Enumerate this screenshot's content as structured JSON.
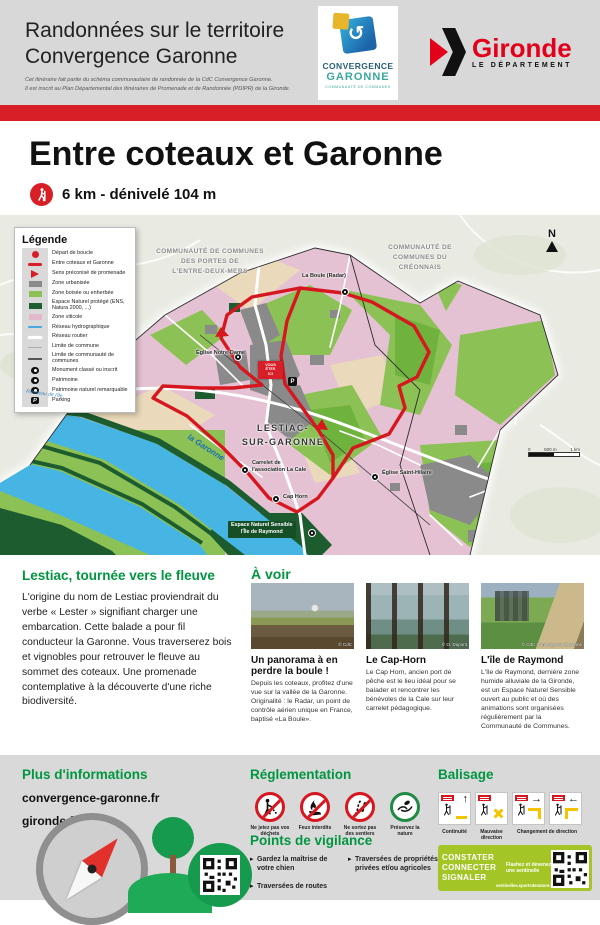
{
  "colors": {
    "accent_red": "#d81e26",
    "heading_green": "#009640",
    "banner_green": "#a3c626",
    "map_vineyard": "#e5c2d3",
    "map_wood": "#8cc155",
    "map_protected": "#1d5d2f",
    "map_water": "#46b5e3"
  },
  "header": {
    "title_line1": "Randonnées sur le territoire",
    "title_line2": "Convergence Garonne",
    "note_line1": "Cet itinéraire fait partie du schéma communautaire de randonnée de la CdC Convergence Garonne.",
    "note_line2": "Il est inscrit au Plan Départemental des Itinéraires de Promenade et de Randonnée (PDIPR) de la Gironde.",
    "convergence_logo": {
      "title1": "CONVERGENCE",
      "title2": "GARONNE",
      "subtitle": "COMMUNAUTÉ DE COMMUNES",
      "swirl": "↺"
    },
    "gironde_logo": {
      "name": "Gironde",
      "department": "LE DÉPARTEMENT"
    }
  },
  "trail": {
    "title": "Entre coteaux et Garonne",
    "stats": "6 km - dénivelé 104 m"
  },
  "map": {
    "legend": {
      "title": "Légende",
      "items": [
        {
          "icon": "route-start",
          "label": "Départ de boucle"
        },
        {
          "icon": "route-line",
          "label": "Entre coteaux et Garonne"
        },
        {
          "icon": "direction-arrow",
          "label": "Sens préconisé de promenade"
        },
        {
          "icon": "zone-urban",
          "label": "Zone urbanisée"
        },
        {
          "icon": "zone-wooded",
          "label": "Zone boisée ou enherbée"
        },
        {
          "icon": "zone-protected",
          "label": "Espace Naturel protégé (ENS, Natura 2000, ...)"
        },
        {
          "icon": "zone-vineyard",
          "label": "Zone viticole"
        },
        {
          "icon": "hydro-network",
          "label": "Réseau hydrographique"
        },
        {
          "icon": "road-network",
          "label": "Réseau routier"
        },
        {
          "icon": "commune-limit",
          "label": "Limite de commune"
        },
        {
          "icon": "cdc-limit",
          "label": "Limite de communauté de communes"
        },
        {
          "icon": "monument",
          "label": "Monument classé ou inscrit"
        },
        {
          "icon": "heritage",
          "label": "Patrimoine"
        },
        {
          "icon": "natural-heritage",
          "label": "Patrimoine naturel remarquable"
        },
        {
          "icon": "parking",
          "label": "Parking"
        }
      ]
    },
    "labels": {
      "cc_left_l1": "COMMUNAUTÉ DE COMMUNES",
      "cc_left_l2": "DES PORTES DE",
      "cc_left_l3": "L'ENTRE-DEUX-MERS",
      "cc_right_l1": "COMMUNAUTÉ DE",
      "cc_right_l2": "COMMUNES DU",
      "cc_right_l3": "CRÉONNAIS",
      "town_l1": "LESTIAC-",
      "town_l2": "SUR-GARONNE",
      "la_boule": "La Boule (Radar)",
      "eglise_notre_dame": "Église Notre-Dame",
      "carrelet_l1": "Carrelet de",
      "carrelet_l2": "l'association La Cale",
      "cap_horn": "Cap Horn",
      "ens_l1": "Espace Naturel Sensible",
      "ens_l2": "l'Île de Raymond",
      "eglise_saint_hilaire": "Église Saint-Hilaire",
      "garonne": "la Garonne",
      "ruisseau": "Ruisseau de l'Île",
      "you_are_here_l1": "VOUS",
      "you_are_here_l2": "ÊTES",
      "you_are_here_l3": "ICI",
      "parking_glyph": "P",
      "north": "N"
    },
    "scale": {
      "start": "0",
      "mid": "500 m",
      "end": "1 km"
    }
  },
  "description": {
    "heading": "Lestiac, tournée vers le fleuve",
    "body": "L'origine du nom de Lestiac proviendrait du verbe « Lester » signifiant charger une embarcation. Cette balade a pour fil conducteur la Garonne. Vous traverserez bois et vignobles pour retrouver le fleuve au sommet des coteaux. Une promenade contemplative à la découverte d'une riche biodiversité."
  },
  "a_voir": {
    "heading": "À voir",
    "cards": [
      {
        "title": "Un panorama à en perdre la boule !",
        "text": "Depuis les coteaux, profitez d'une vue sur la vallée de la Garonne. Originalité : le Radar, un point de contrôle aérien unique en France, baptisé «La Boule».",
        "credit": "© CdC"
      },
      {
        "title": "Le Cap-Horn",
        "text": "Le Cap Horn, ancien port de pêche est le lieu idéal pour se balader et rencontrer les bénévoles de la Cale sur leur carrelet pédagogique.",
        "credit": "© O. Dupont"
      },
      {
        "title": "L'île de Raymond",
        "text": "L'île de Raymond, dernière zone humide alluviale de la Gironde, est un Espace Naturel Sensible ouvert au public et où des animations sont organisées régulièrement par la Communauté de Communes.",
        "credit": "© CdC Convergence Garonne"
      }
    ]
  },
  "footer": {
    "info": {
      "heading": "Plus d'informations",
      "link1": "convergence-garonne.fr",
      "link2": "gironde.fr"
    },
    "reglementation": {
      "heading": "Réglementation",
      "pictos": [
        {
          "icon": "no-litter",
          "label": "Ne jetez pas vos déchets"
        },
        {
          "icon": "no-fire",
          "label": "Feux interdits"
        },
        {
          "icon": "stay-on-trail",
          "label": "Ne sortez pas des sentiers"
        },
        {
          "icon": "protect-nature",
          "label": "Préservez la nature"
        }
      ]
    },
    "vigilance": {
      "heading": "Points de vigilance",
      "items": [
        "Gardez la maîtrise de votre chien",
        "Traversées de routes",
        "Traversées de propriétés privées et/ou agricoles"
      ]
    },
    "balisage": {
      "heading": "Balisage",
      "captions": [
        "Continuité",
        "Mauvaise direction",
        "Changement de direction"
      ],
      "arrows": {
        "up": "↑",
        "right": "→",
        "left": "←"
      }
    },
    "sentinelle": {
      "word1": "CONSTATER",
      "word2": "CONNECTER",
      "word3": "SIGNALER",
      "tagline": "Flashez et devenez une sentinelle",
      "url": "sentinelles.sportsdenature.fr"
    }
  }
}
